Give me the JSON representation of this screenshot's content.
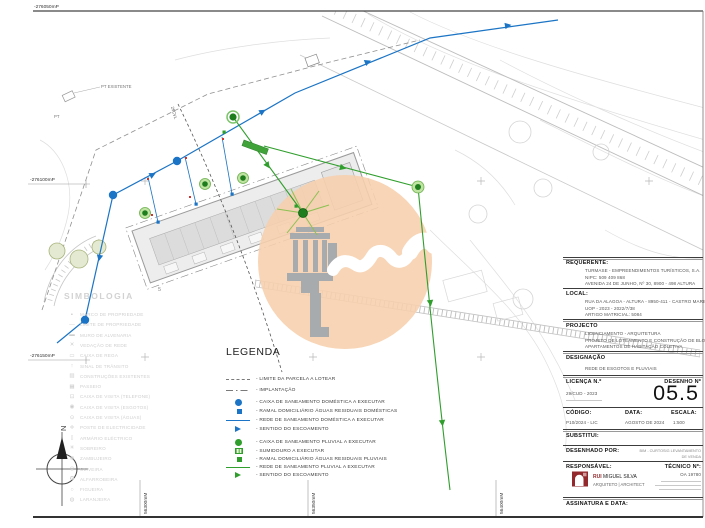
{
  "sheet": {
    "grid_left": [
      "-276050mP",
      "-276100mP",
      "-276150mP"
    ],
    "grid_bottom": [
      "56300mM",
      "56350mM",
      "56400mM"
    ]
  },
  "plan": {
    "pt_label": "PT EXISTENTE",
    "pt_abbr": "PT",
    "cable_label": "25CVL",
    "lot_number": "5",
    "north": "N"
  },
  "simbologia": {
    "title": "SIMBOLOGIA",
    "items": [
      {
        "glyph": "▪",
        "label": "MARCO DE PROPRIEDADE"
      },
      {
        "glyph": "—",
        "label": "LIMITE DE PROPRIEDADE"
      },
      {
        "glyph": "▬",
        "label": "MURO DE ALVENARIA"
      },
      {
        "glyph": "✕",
        "label": "VEDAÇÃO DE REDE"
      },
      {
        "glyph": "▭",
        "label": "CAIXA DE REGA"
      },
      {
        "glyph": "↑",
        "label": "SINAL DE TRÂNSITO"
      },
      {
        "glyph": "▨",
        "label": "CONSTRUÇÕES EXISTENTES"
      },
      {
        "glyph": "▦",
        "label": "PASSEIO"
      },
      {
        "glyph": "⊡",
        "label": "CAIXA DE VISITA (TELEFONE)"
      },
      {
        "glyph": "◉",
        "label": "CAIXA DE VISITA (ESGOTOS)"
      },
      {
        "glyph": "⊙",
        "label": "CAIXA DE VISITA (ÁGUAS)"
      },
      {
        "glyph": "✛",
        "label": "POSTE DE ELECTRICIDADE"
      },
      {
        "glyph": "▯",
        "label": "ARMÁRIO ELÉCTRICO"
      },
      {
        "glyph": "✳",
        "label": "SOBREIRO"
      },
      {
        "glyph": "❋",
        "label": "ZAMBUJEIRO"
      },
      {
        "glyph": "◎",
        "label": "OLIVEIRA"
      },
      {
        "glyph": "✪",
        "label": "ALFARROBEIRA"
      },
      {
        "glyph": "○",
        "label": "FIGUEIRA"
      },
      {
        "glyph": "◍",
        "label": "LARANJEIRA"
      }
    ]
  },
  "legend": {
    "title": "LEGENDA",
    "items": [
      {
        "symbol": "dashed-line",
        "label": "- LIMITE DA PARCELA A LOTEAR"
      },
      {
        "symbol": "dashdot-line",
        "label": "- IMPLANTAÇÃO"
      },
      {
        "symbol": "blue-circle",
        "label": "- CAIXA DE SANEAMENTO DOMÉSTICA A EXECUTAR"
      },
      {
        "symbol": "blue-square",
        "label": "- RAMAL DOMICILIÁRIO ÁGUAS RESIDUAIS DOMÉSTICAS"
      },
      {
        "symbol": "blue-line",
        "label": "- REDE DE SANEAMENTO DOMÉSTICA A EXECUTAR"
      },
      {
        "symbol": "blue-arrow",
        "label": "- SENTIDO DO ESCOAMENTO"
      },
      {
        "symbol": "green-circle",
        "label": "- CAIXA DE SANEAMENTO PLUVIAL A EXECUTAR"
      },
      {
        "symbol": "green-grate",
        "label": "- SUMIDOURO A EXECUTAR"
      },
      {
        "symbol": "green-square",
        "label": "- RAMAL DOMICILIÁRIO ÁGUAS RESIDUAIS PLUVIAIS"
      },
      {
        "symbol": "green-line",
        "label": "- REDE DE SANEAMENTO PLUVIAL A EXECUTAR"
      },
      {
        "symbol": "green-arrow",
        "label": "- SENTIDO DO ESCOAMENTO"
      }
    ]
  },
  "titleblock": {
    "requerente": {
      "label": "REQUERENTE:",
      "lines": [
        "TURMASE - EMPREENDIMENTOS TURÍSTICOS, S.A.",
        "NIPC: 509 409 868",
        "AVENIDA 24 DE JUNHO, Nº 30, 8900 - 498 ALTURA"
      ]
    },
    "local": {
      "label": "LOCAL:",
      "lines": [
        "RUA DA ALAGOA - ALTURA - 8950-411 - CASTRO MARIM",
        "UOP - 2023 - 2022/7/38",
        "ARTIGO MATRICIAL: 5084"
      ]
    },
    "projecto": {
      "label": "PROJECTO",
      "lines": [
        "LICENCIAMENTO - ARQUITETURA",
        "PROJETO DE LOTEAMENTO E CONSTRUÇÃO DE BLOCO DE",
        "APARTAMENTOS DE HABITAÇÃO COLETIVA"
      ]
    },
    "designacao": {
      "label": "DESIGNAÇÃO",
      "lines": [
        "REDE DE ESGOTOS E PLUVIAIS"
      ]
    },
    "licenca": {
      "label": "LICENÇA N.º",
      "value": "29/CUD - 2023"
    },
    "desenho": {
      "label": "DESENHO Nº",
      "value": "05.5"
    },
    "codigo": {
      "label": "CÓDIGO:",
      "value": "P10/2024 - LIC"
    },
    "data": {
      "label": "DATA:",
      "value": "AGOSTO DE 2024"
    },
    "escala": {
      "label": "ESCALA:",
      "value": "1:500"
    },
    "substitui": {
      "label": "SUBSTITUI:"
    },
    "desenhado": {
      "label": "DESENHADO POR:",
      "line1": "BIM - CURTOSIG LEVANTAMENTO",
      "line2": "DE VENDA"
    },
    "responsavel": {
      "label": "RESPONSÁVEL:",
      "name_red": "RUI",
      "name_rest": " MIGUEL SILVA",
      "title": "ARQUITETO | ARCHITECT"
    },
    "tecnico": {
      "label": "TÉCNICO Nº:",
      "value": "OA 19780"
    },
    "assinatura": {
      "label": "ASSINATURA E DATA:"
    }
  },
  "colors": {
    "network_blue": "#1b74c5",
    "network_green": "#2f9e2c",
    "watermark_orange": "#f6cfac",
    "watermark_tower_gray": "#a2a8ad",
    "logo_red": "#93292c",
    "faint_gray": "#cfcfcf"
  }
}
